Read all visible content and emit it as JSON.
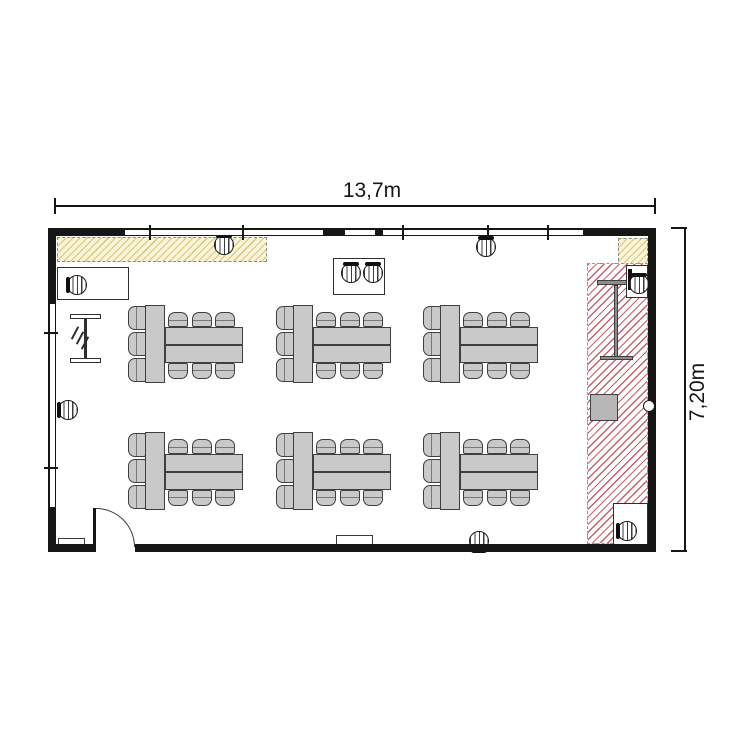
{
  "floorplan": {
    "type": "classroom-floor-plan",
    "dimension_top_label": "13,7m",
    "dimension_right_label": "7,20m",
    "colors": {
      "wall": "#161616",
      "furniture_fill": "#c9c9c9",
      "furniture_border": "#3f3f3f",
      "yellow_fill": "#faf5d8",
      "yellow_line": "#d6c67c",
      "red_line": "#c4606e",
      "dim_color": "#161616",
      "background": "#ffffff"
    },
    "inventory": {
      "table_groups": 6,
      "chairs_per_group": 9,
      "total_group_chairs": 54,
      "stool_chairs": 9,
      "doors": 1,
      "hatched_zones": 3
    },
    "furniture": {
      "table_groups": [
        {
          "x": 145,
          "y": 305
        },
        {
          "x": 293,
          "y": 305
        },
        {
          "x": 440,
          "y": 305
        },
        {
          "x": 145,
          "y": 432
        },
        {
          "x": 293,
          "y": 432
        },
        {
          "x": 440,
          "y": 432
        }
      ],
      "stools": [
        {
          "x": 224,
          "y": 245,
          "back": "top"
        },
        {
          "x": 486,
          "y": 247,
          "back": "top"
        },
        {
          "x": 77,
          "y": 285,
          "back": "left"
        },
        {
          "x": 68,
          "y": 410,
          "back": "left"
        },
        {
          "x": 479,
          "y": 541,
          "back": "bottom"
        },
        {
          "x": 351,
          "y": 273,
          "back": "top"
        },
        {
          "x": 373,
          "y": 273,
          "back": "top"
        },
        {
          "x": 639,
          "y": 284,
          "back": "top"
        },
        {
          "x": 627,
          "y": 531,
          "back": "left"
        }
      ],
      "desks": [
        {
          "x": 57,
          "y": 267,
          "w": 72,
          "h": 33
        },
        {
          "x": 626,
          "y": 265,
          "w": 22,
          "h": 33,
          "bar": "left"
        },
        {
          "x": 613,
          "y": 503,
          "w": 35,
          "h": 46
        },
        {
          "x": 333,
          "y": 258,
          "w": 52,
          "h": 37
        }
      ],
      "radiators": [
        {
          "x": 58,
          "y": 538,
          "w": 27,
          "h": 9
        },
        {
          "x": 336,
          "y": 535,
          "w": 37,
          "h": 11
        }
      ],
      "flipchart_bars": [
        {
          "x": 597,
          "y": 280,
          "w": 40,
          "h": 5
        },
        {
          "x": 614,
          "y": 285,
          "w": 4,
          "h": 73
        },
        {
          "x": 600,
          "y": 356,
          "w": 33,
          "h": 4
        }
      ],
      "equipment_square": {
        "x": 590,
        "y": 394,
        "w": 28,
        "h": 27
      }
    },
    "zones": [
      {
        "name": "hatched-strip-top-left",
        "color": "yellow",
        "x": 57,
        "y": 237,
        "w": 210,
        "h": 25
      },
      {
        "name": "hatched-square-top-right",
        "color": "yellow",
        "x": 618,
        "y": 238,
        "w": 30,
        "h": 28
      },
      {
        "name": "hatched-zone-right",
        "color": "red",
        "x": 587,
        "y": 263,
        "w": 61,
        "h": 281
      }
    ]
  }
}
